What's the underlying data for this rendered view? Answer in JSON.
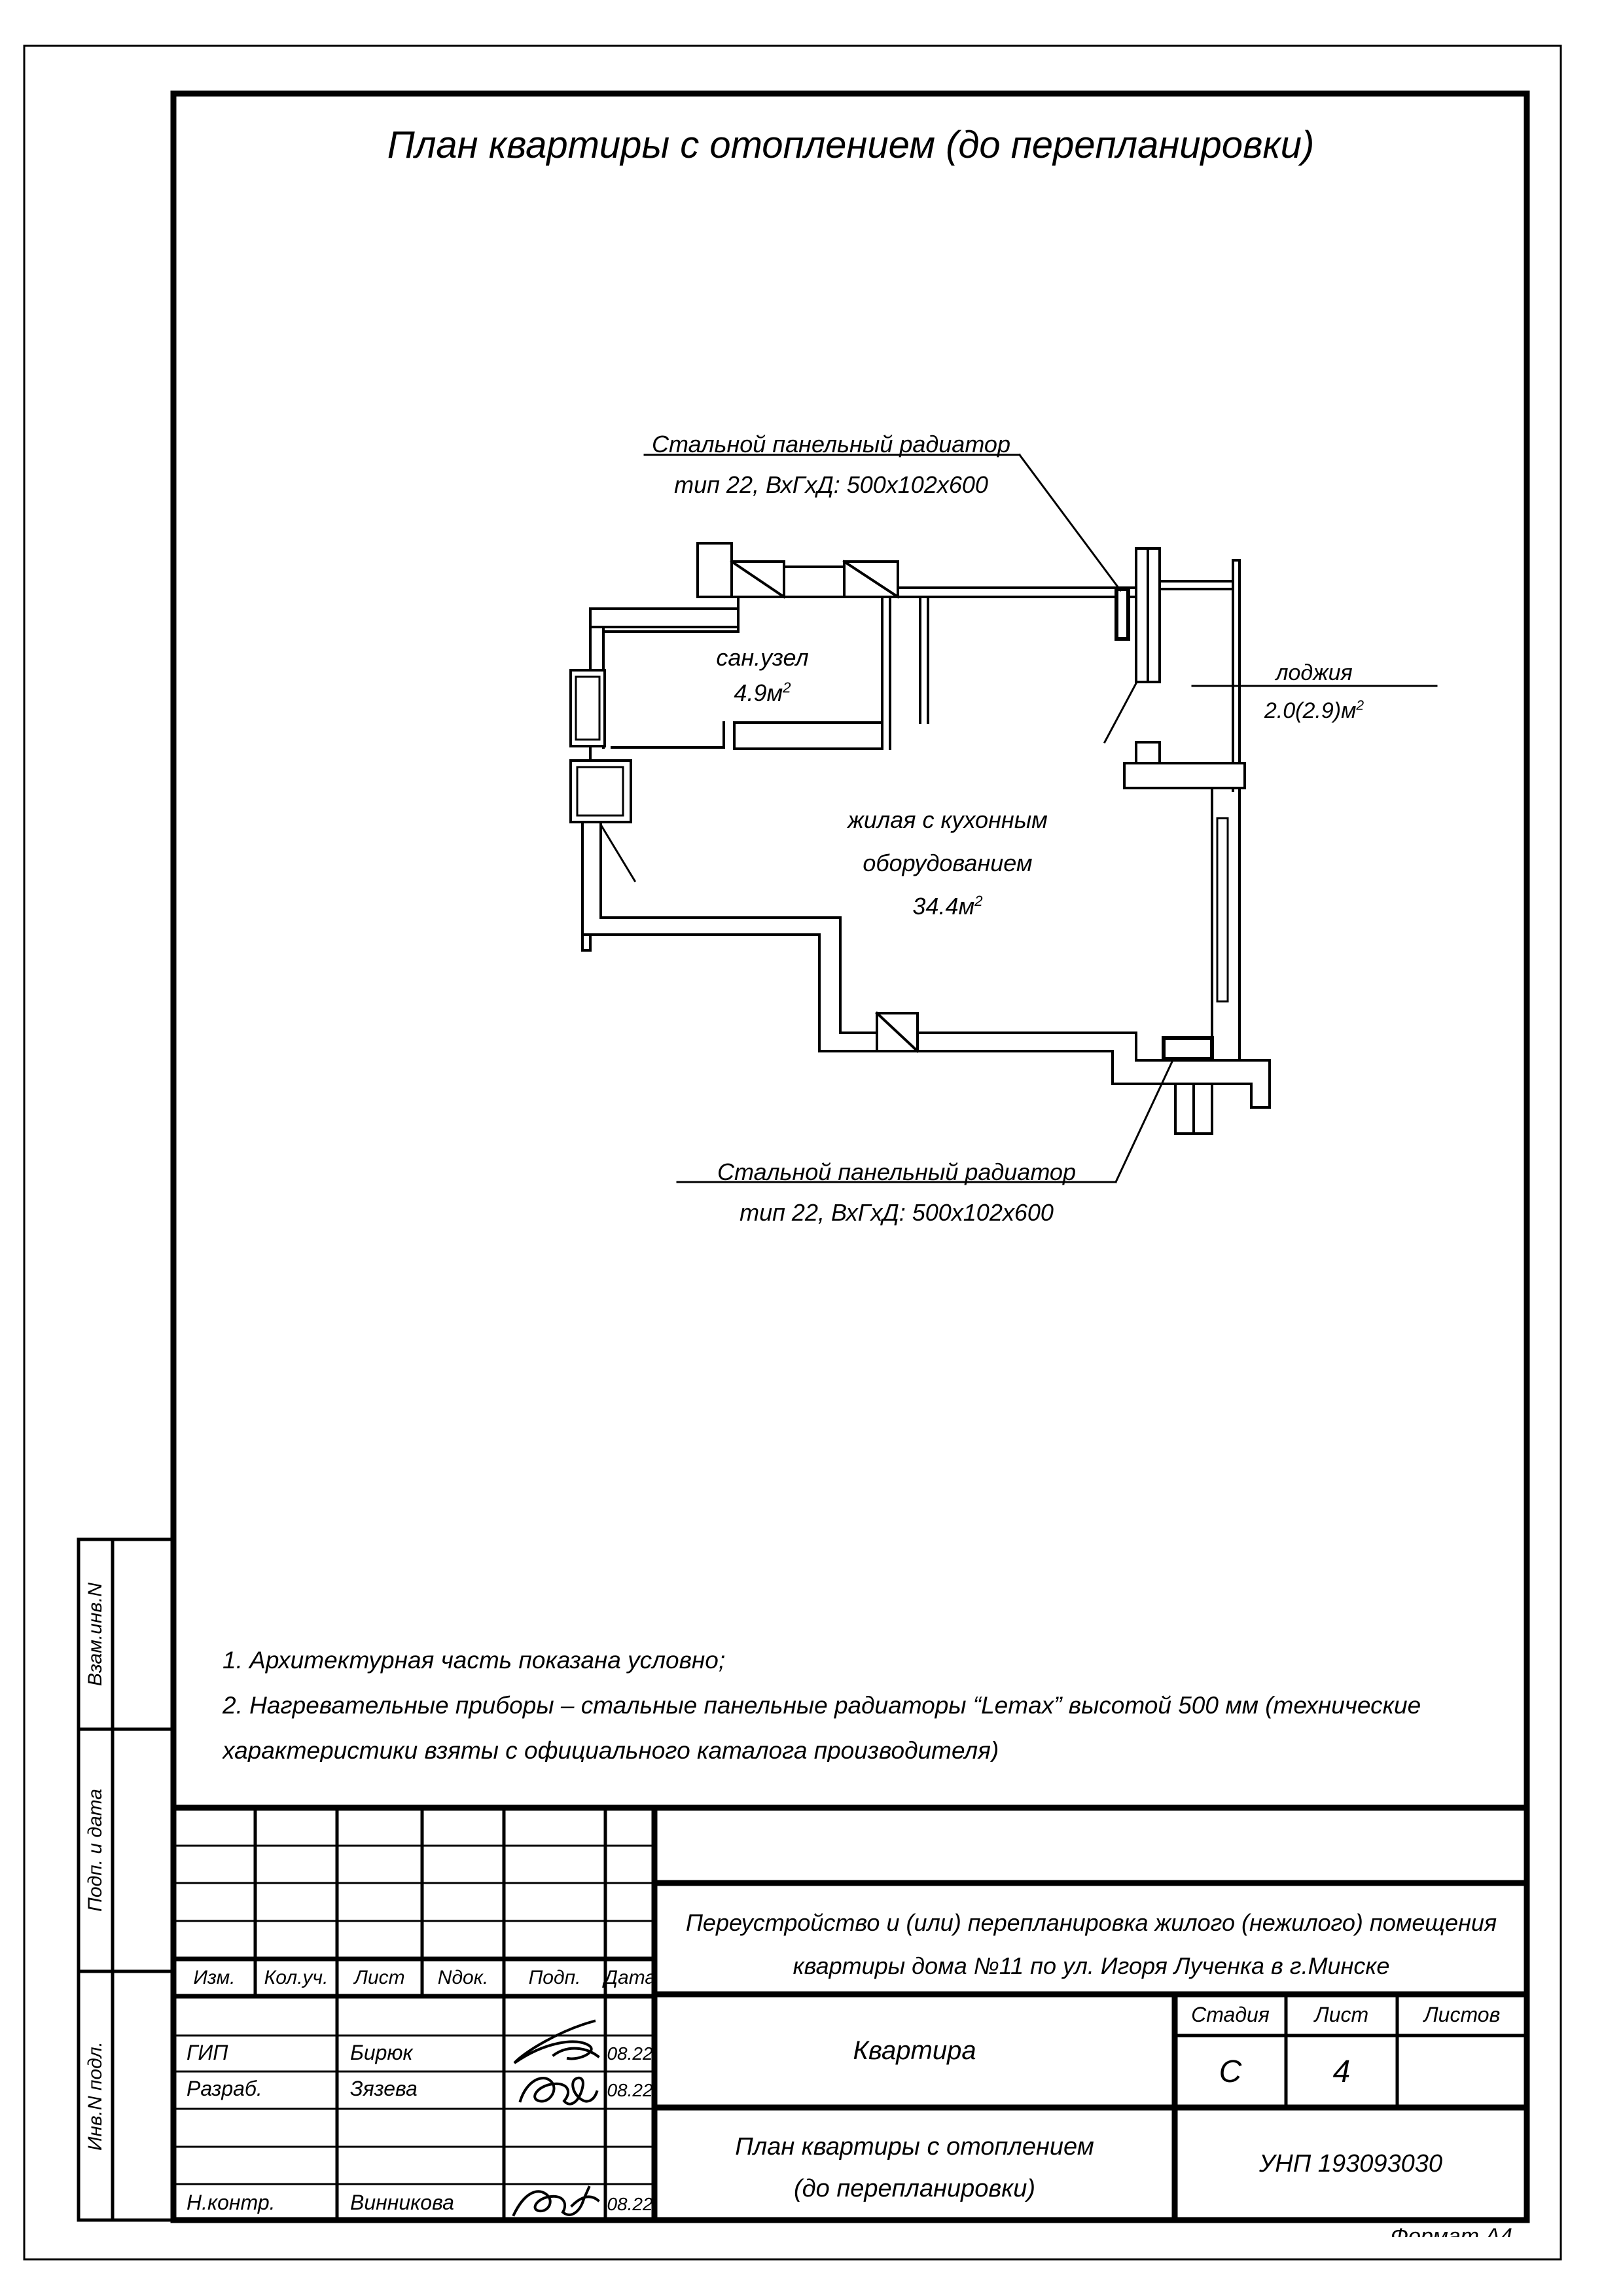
{
  "page": {
    "title": "План квартиры с отоплением (до перепланировки)",
    "format_label": "Формат А4"
  },
  "plan": {
    "radiator_label_top": {
      "line1": "Стальной панельный радиатор",
      "line2": "тип 22, ВхГхД: 500х102х600"
    },
    "radiator_label_bottom": {
      "line1": "Стальной панельный радиатор",
      "line2": "тип 22, ВхГхД: 500х102х600"
    },
    "rooms": {
      "bathroom": {
        "name": "сан.узел",
        "area": "4.9м",
        "area_sup": "2"
      },
      "living": {
        "line1": "жилая с кухонным",
        "line2": "оборудованием",
        "area": "34.4м",
        "area_sup": "2"
      },
      "loggia": {
        "name": "лоджия",
        "area": "2.0(2.9)м",
        "area_sup": "2"
      }
    }
  },
  "notes": {
    "note1": "1.      Архитектурная часть показана условно;",
    "note2": "2.       Нагревательные приборы – стальные панельные радиаторы “Lemax” высотой 500 мм (технические",
    "note3": "характеристики взяты с официального каталога производителя)"
  },
  "sidebar": {
    "items": [
      "Взам.инв.N",
      "Подп. и дата",
      "Инв.N подл."
    ]
  },
  "titleblock": {
    "header_cols": [
      "Изм.",
      "Кол.уч.",
      "Лист",
      "Nдок.",
      "Подп.",
      "Дата"
    ],
    "rows": [
      {
        "role": "ГИП",
        "name": "Бирюк",
        "date": "08.22"
      },
      {
        "role": "Разраб.",
        "name": "Зязева",
        "date": "08.22"
      },
      {
        "role": "Н.контр.",
        "name": "Винникова",
        "date": "08.22"
      }
    ],
    "project": {
      "line1": "Переустройство и  (или) перепланировка жилого (нежилого) помещения",
      "line2": "квартиры  дома №11 по ул. Игоря Лученка в г.Минске"
    },
    "object": "Квартира",
    "stage_label": "Стадия",
    "sheet_label": "Лист",
    "sheets_label": "Листов",
    "stage": "С",
    "sheet": "4",
    "sheets": "",
    "doc": {
      "line1": "План квартиры с отоплением",
      "line2": "(до перепланировки)"
    },
    "unp": "УНП 193093030"
  }
}
